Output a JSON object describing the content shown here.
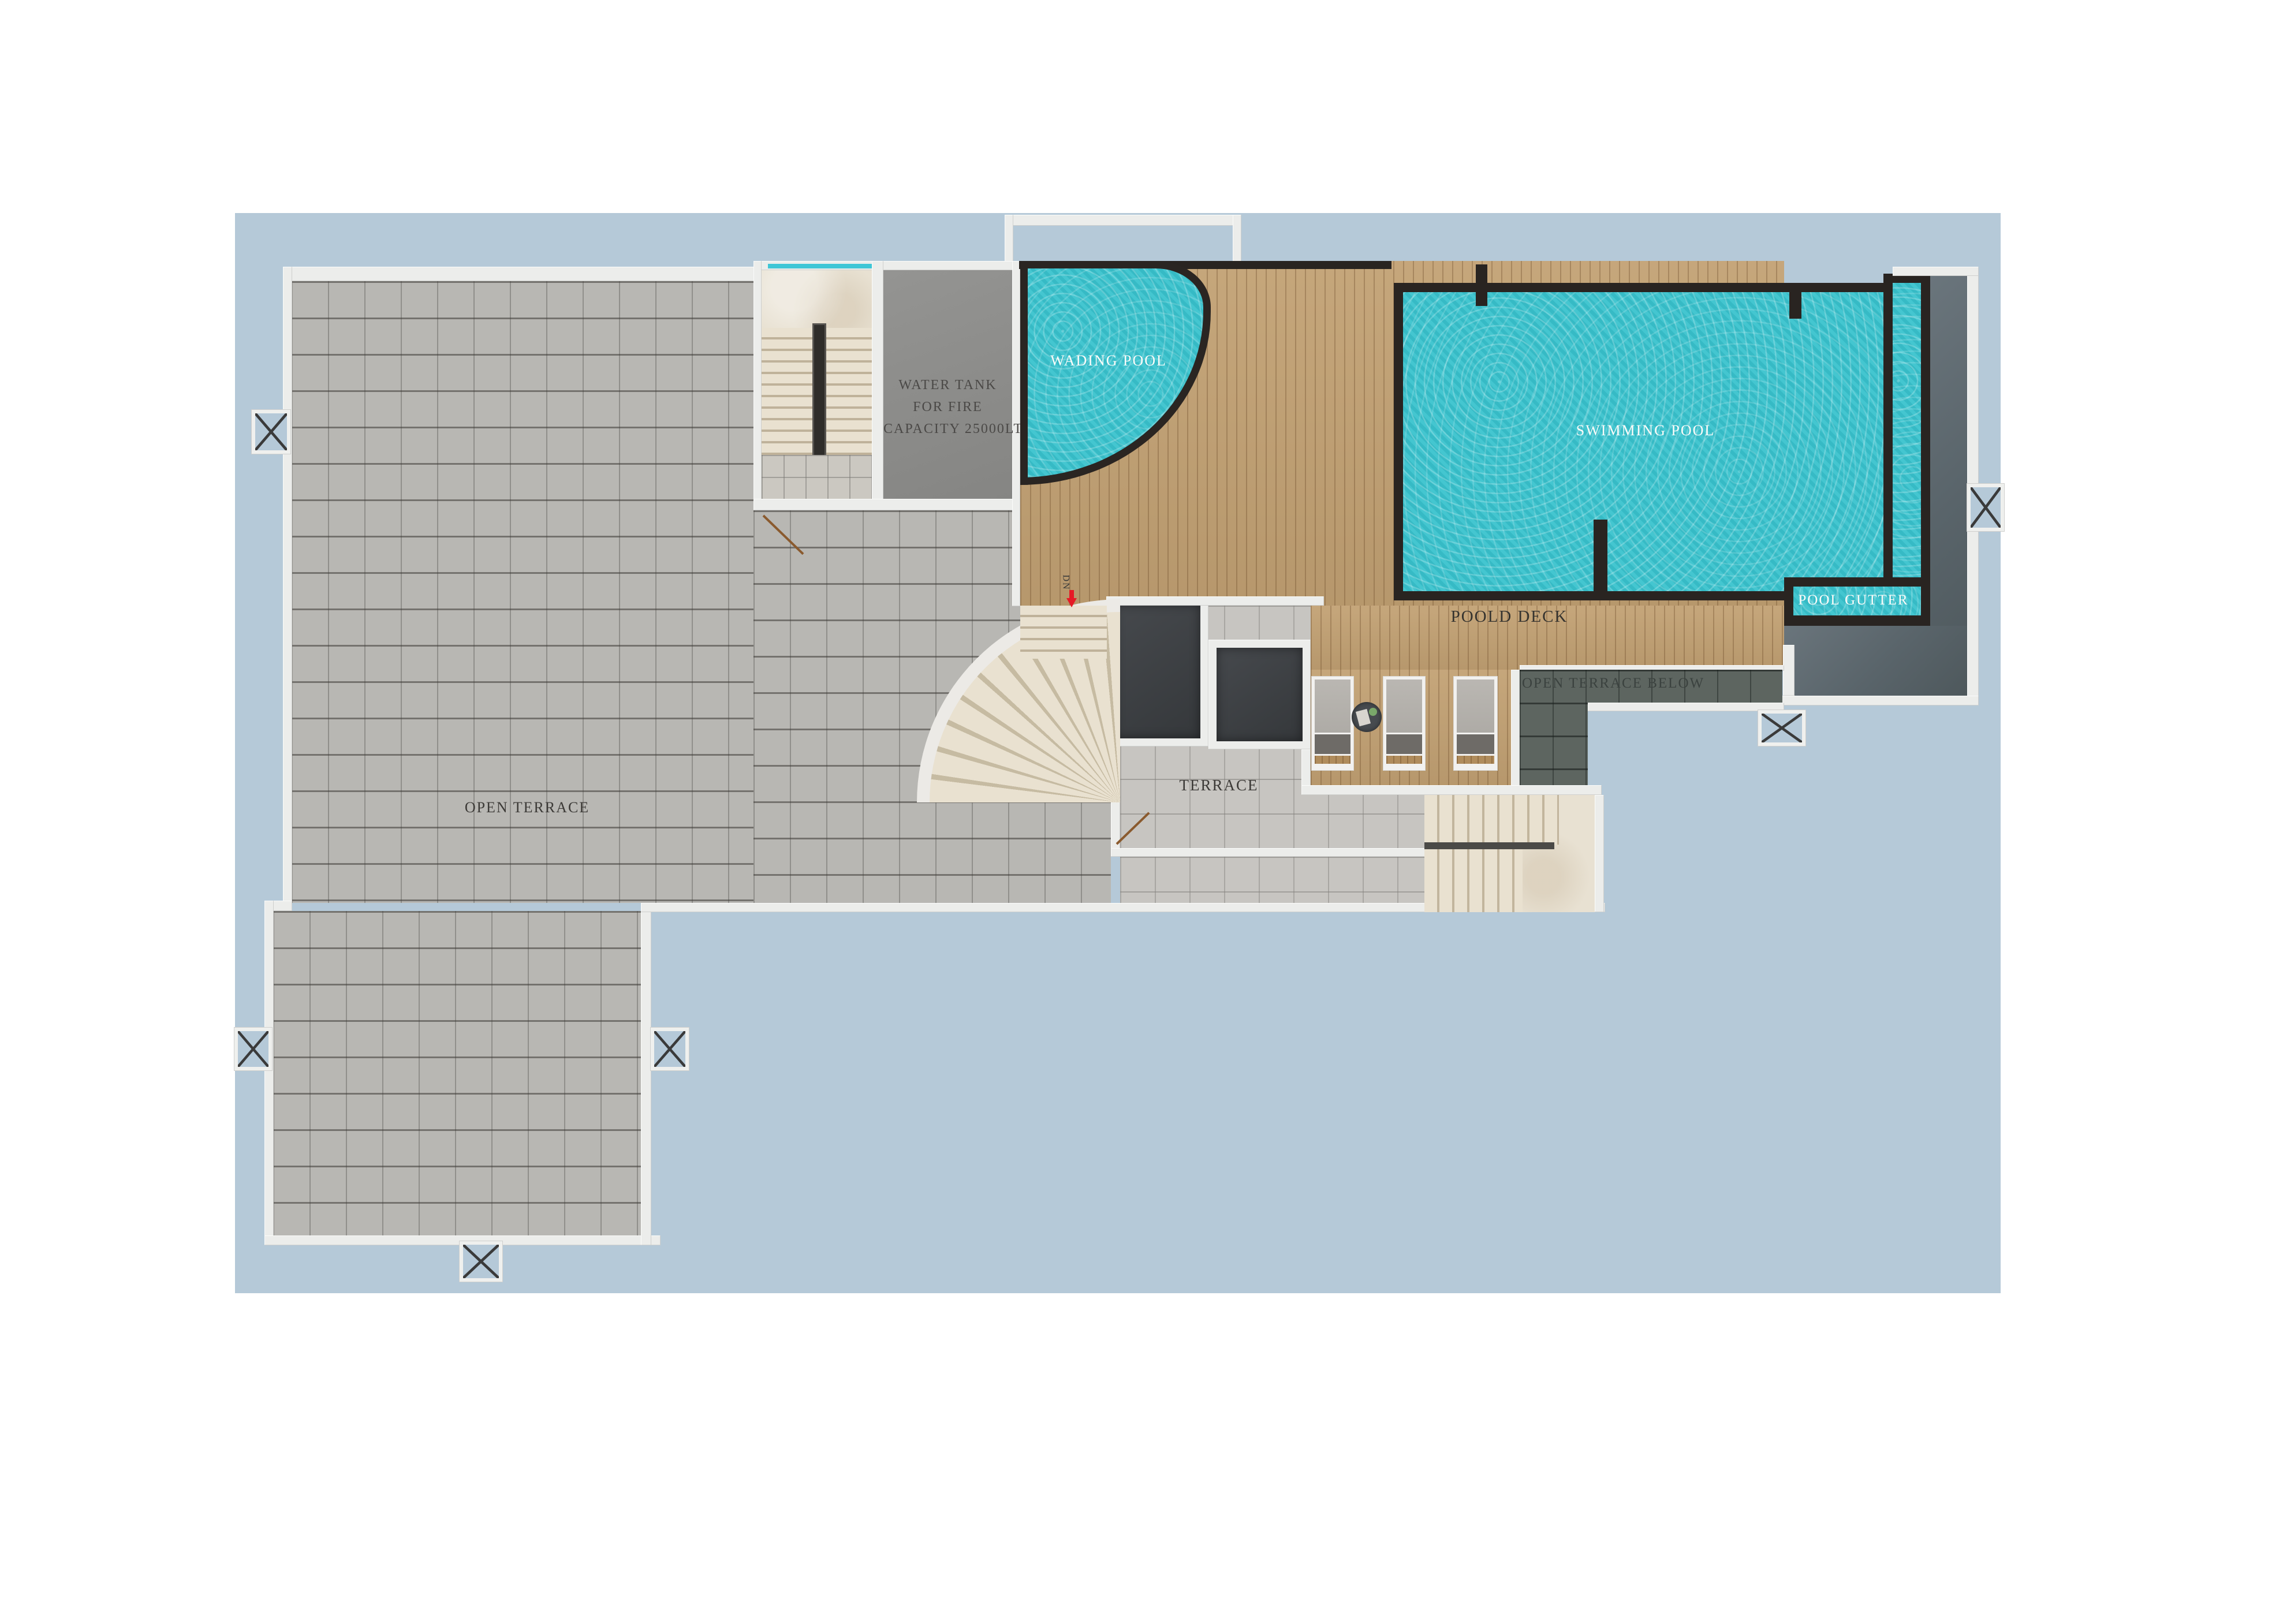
{
  "labels": {
    "wading_pool": "WADING POOL",
    "swimming_pool": "SWIMMING POOL",
    "pool_gutter": "POOL GUTTER",
    "pool_deck": "POOLD DECK",
    "open_terrace_below": "OPEN TERRACE BELOW",
    "terrace": "TERRACE",
    "open_terrace": "OPEN TERRACE",
    "water_tank_line1": "WATER TANK",
    "water_tank_line2": "FOR FIRE",
    "water_tank_line3": "CAPACITY 25000LTR",
    "down": "DN"
  },
  "colors": {
    "page_background": "#ffffff",
    "site_blue": "#b5c9d8",
    "pool_water": "#38c2cd",
    "pool_edge": "#292421",
    "deck_wood": "#c2a173",
    "terrace_tile": "#b8b7b3",
    "dark_tile": "#5d6560",
    "slate_gray": "#59646a",
    "wall_white": "#ecedeb",
    "marble": "#e8e1d2",
    "label_dark": "#3c3a37",
    "label_light": "#fbfbf9",
    "dn_arrow_red": "#e51a26",
    "glass_teal": "#3fc6d6"
  }
}
